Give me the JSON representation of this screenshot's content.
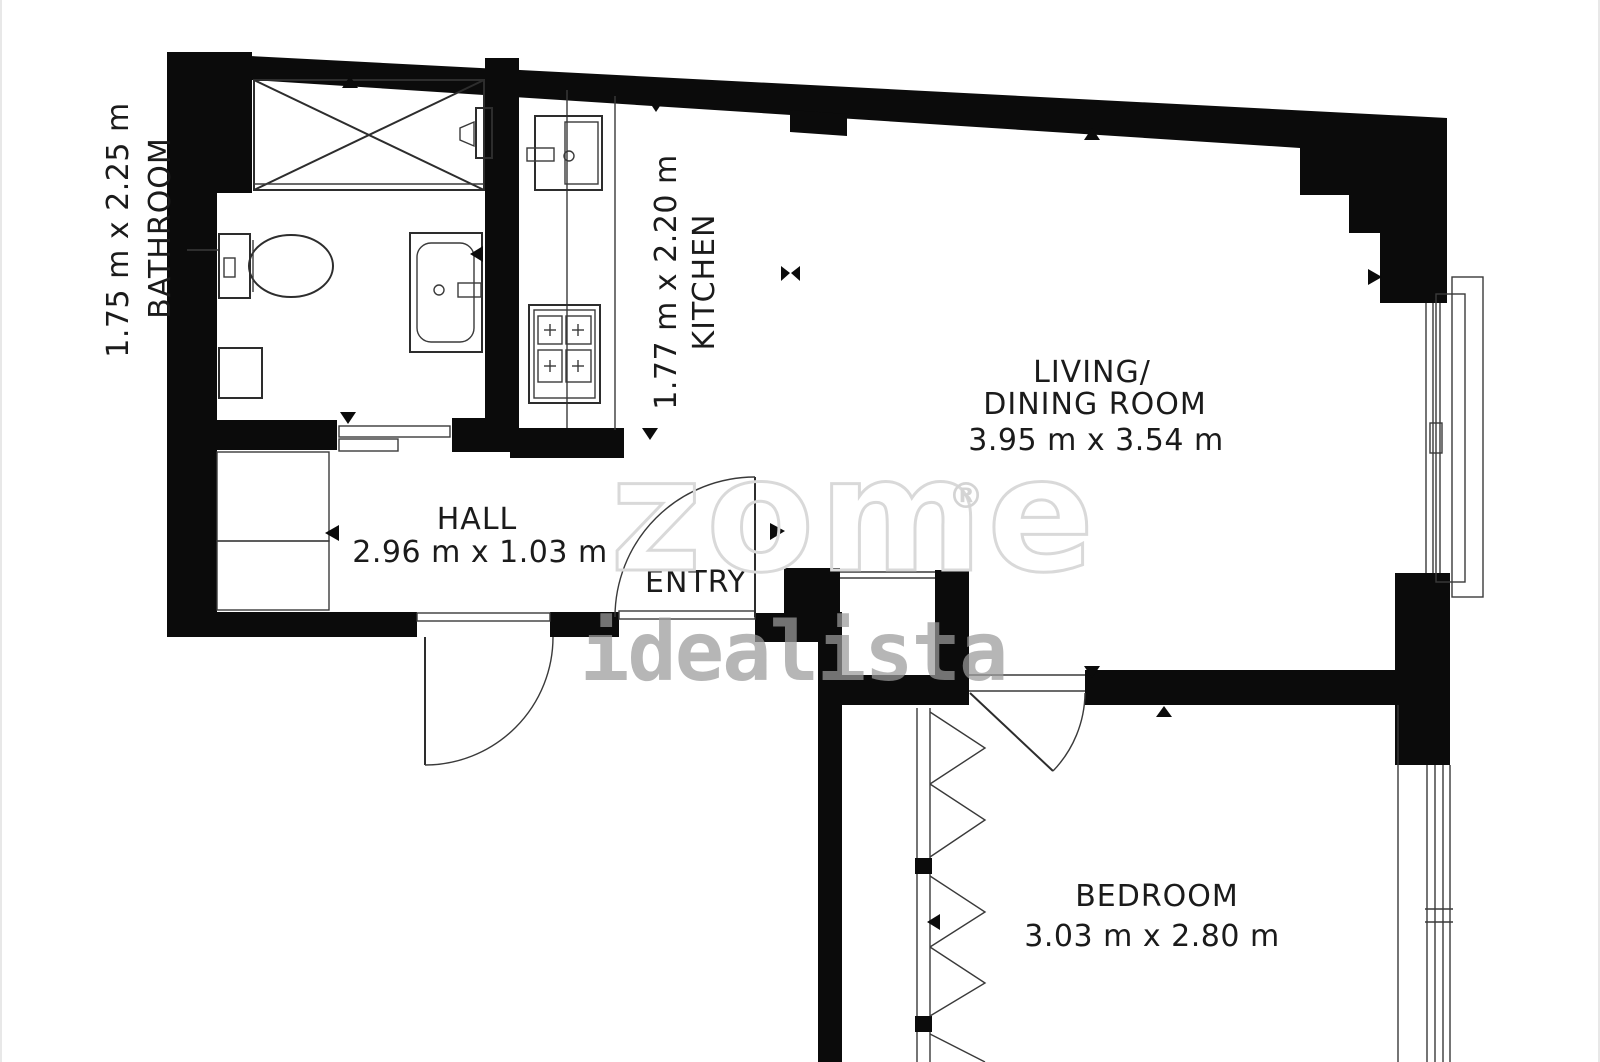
{
  "plan": {
    "type": "floor-plan",
    "rooms": {
      "bathroom": {
        "name": "BATHROOM",
        "dims": "1.75 m x 2.25 m"
      },
      "kitchen": {
        "name": "KITCHEN",
        "dims": "1.77 m x 2.20 m"
      },
      "living": {
        "name_line1": "LIVING/",
        "name_line2": "DINING ROOM",
        "dims": "3.95 m x 3.54 m"
      },
      "hall": {
        "name": "HALL",
        "dims": "2.96 m x 1.03 m"
      },
      "entry": {
        "name": "ENTRY"
      },
      "bedroom": {
        "name": "BEDROOM",
        "dims": "3.03 m x 2.80 m"
      }
    },
    "fixtures": [
      "shower",
      "toilet",
      "washbasin",
      "bathroom-cabinet",
      "sliding-door",
      "kitchen-sink",
      "stove",
      "kitchen-counter",
      "entry-door",
      "hall-exterior-door",
      "bedroom-door",
      "wardrobe-folding-doors",
      "living-room-window",
      "bedroom-window",
      "service-shaft"
    ],
    "colors": {
      "background": "#ffffff",
      "walls": "#0b0b0b",
      "fixture_lines": "#2d2d2d",
      "label_text": "#1b1b1b",
      "watermark_outline": "#d9d9d9",
      "watermark_gray": "#9b9b9b"
    }
  },
  "watermarks": {
    "primary": "zome",
    "registered": "®",
    "secondary": "idealista"
  }
}
